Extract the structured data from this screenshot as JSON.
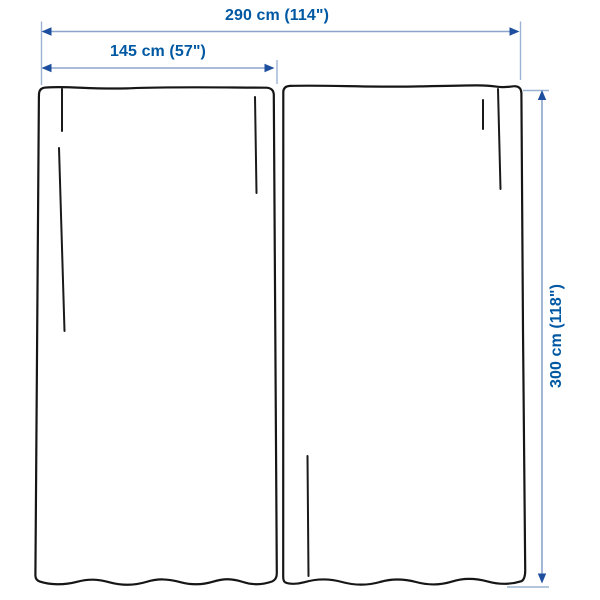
{
  "diagram": {
    "title": "curtain-pair-dimension-diagram",
    "measurements": {
      "total_width": {
        "cm": 290,
        "inches": 114,
        "label": "290 cm (114\")"
      },
      "panel_width": {
        "cm": 145,
        "inches": 57,
        "label": "145 cm (57\")"
      },
      "height": {
        "cm": 300,
        "inches": 118,
        "label": "300 cm (118\")"
      }
    },
    "panel_count": 2
  },
  "colors": {
    "dimension_text": "#0058a3",
    "dimension_line": "#8aa4cb",
    "arrowhead": "#1d4f9e",
    "curtain_outline": "#161616",
    "background": "#ffffff"
  }
}
